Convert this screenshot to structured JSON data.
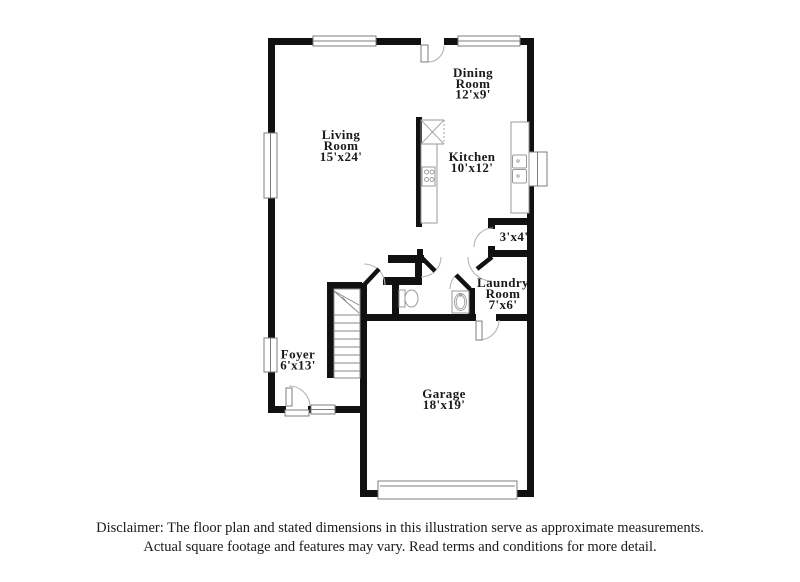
{
  "plan": {
    "rooms": [
      {
        "id": "dining-room",
        "lines": [
          "Dining",
          "Room",
          "12'x9'"
        ]
      },
      {
        "id": "living-room",
        "lines": [
          "Living",
          "Room",
          "15'x24'"
        ]
      },
      {
        "id": "kitchen",
        "lines": [
          "Kitchen",
          "10'x12'"
        ]
      },
      {
        "id": "closet",
        "lines": [
          "3'x4'"
        ]
      },
      {
        "id": "laundry-room",
        "lines": [
          "Laundry",
          "Room",
          "7'x6'"
        ]
      },
      {
        "id": "foyer",
        "lines": [
          "Foyer",
          "6'x13'"
        ]
      },
      {
        "id": "garage",
        "lines": [
          "Garage",
          "18'x19'"
        ]
      }
    ],
    "colors": {
      "wall": "#111111",
      "thin_line": "#8a8a8a",
      "door_arc": "#b5b5b5",
      "text": "#1a1a1a",
      "background": "#ffffff"
    }
  },
  "disclaimer": {
    "line1": "Disclaimer: The floor plan and stated dimensions in this illustration serve as approximate measurements.",
    "line2": "Actual square footage and features may vary. Read terms and conditions for more detail."
  }
}
